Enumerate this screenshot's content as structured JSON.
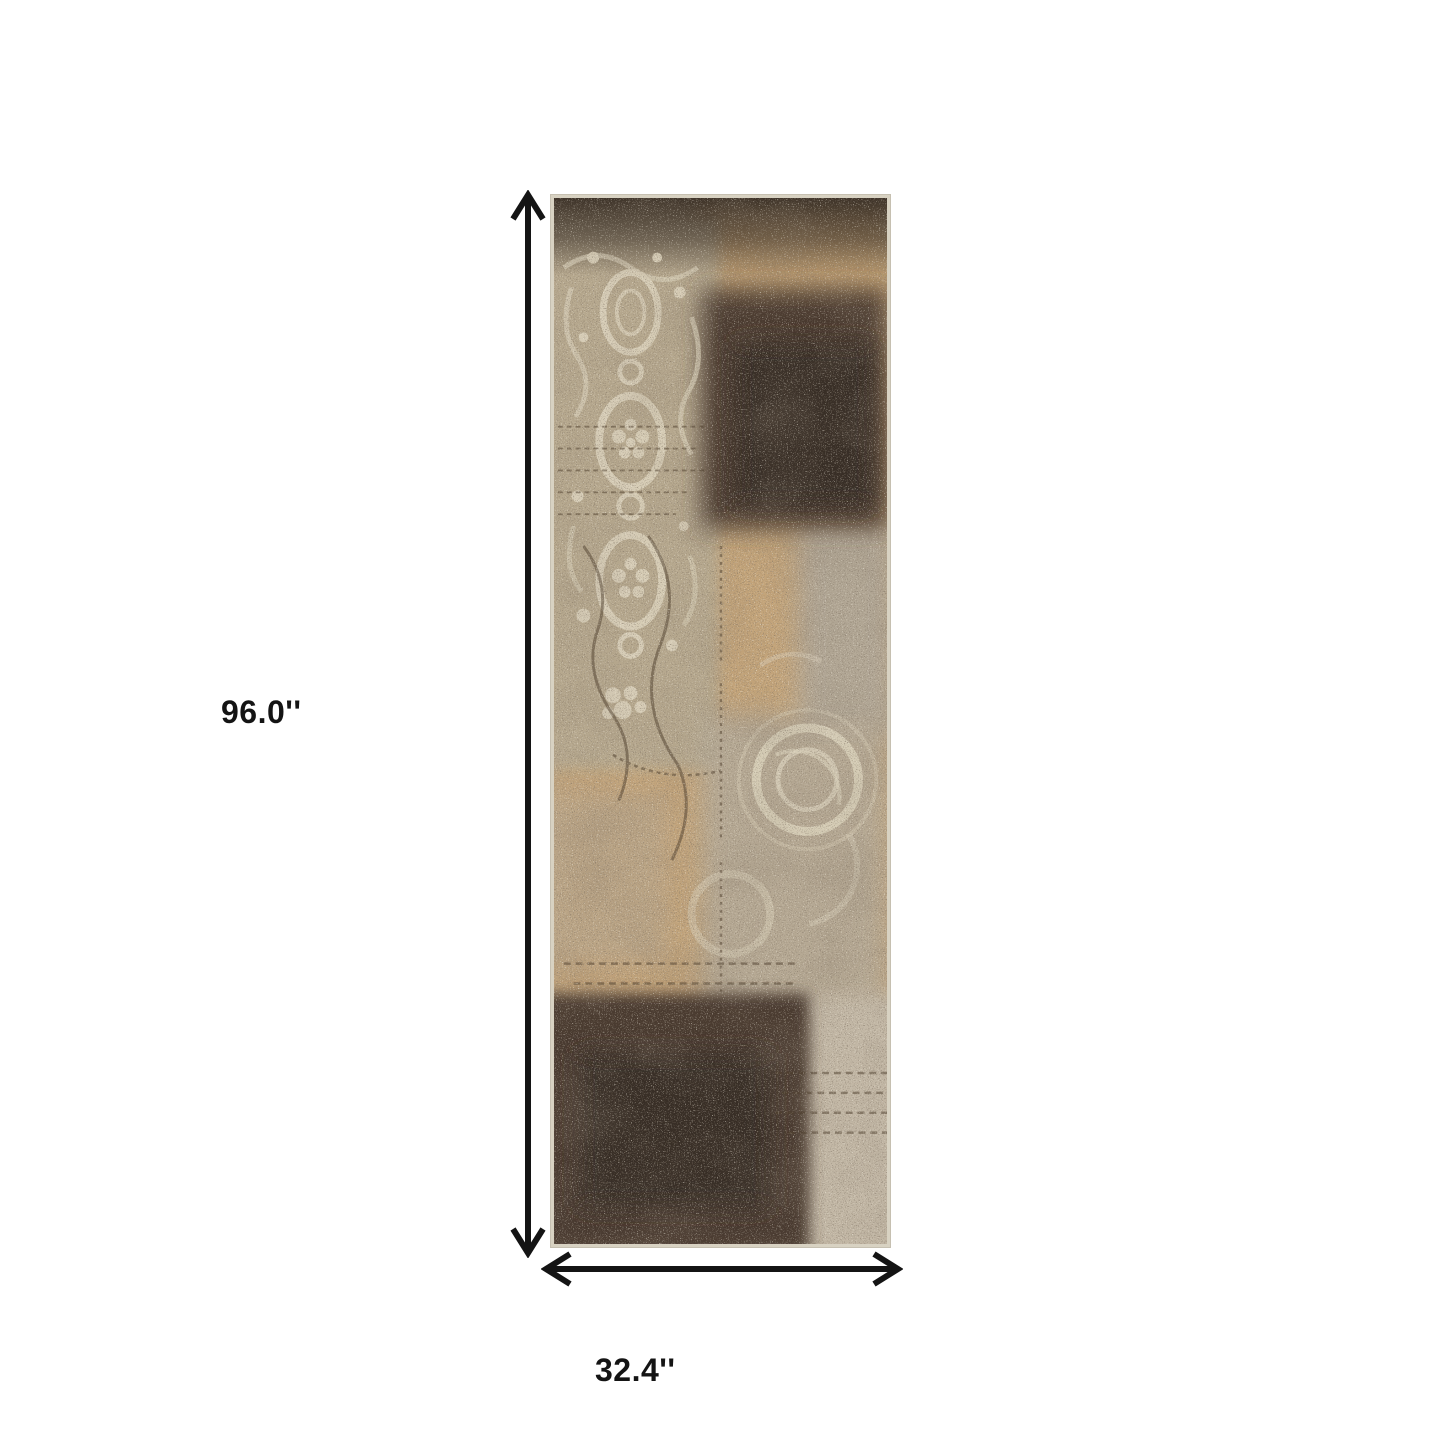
{
  "diagram": {
    "background_color": "#ffffff",
    "arrow_color": "#141414",
    "label_color": "#141414",
    "height_label": "96.0''",
    "width_label": "32.4''"
  },
  "rug": {
    "name": "distressed-patchwork-runner-rug",
    "edge_color": "#d8d2c2",
    "palette": {
      "base_beige": "#bfae92",
      "damask_taupe": "#b6a88e",
      "damask_cream": "#dcd3bd",
      "camel": "#bc9c71",
      "tan": "#c3a47a",
      "orange_tan": "#c89a66",
      "dark_brown": "#46392d",
      "darker_brown": "#382e25",
      "top_band_brown": "#372d24",
      "grey_taupe": "#b1a694",
      "medallion_grey": "#b4a996",
      "light_grey_beige": "#c2b7a5",
      "tracery_brown": "#4a3a28"
    }
  }
}
